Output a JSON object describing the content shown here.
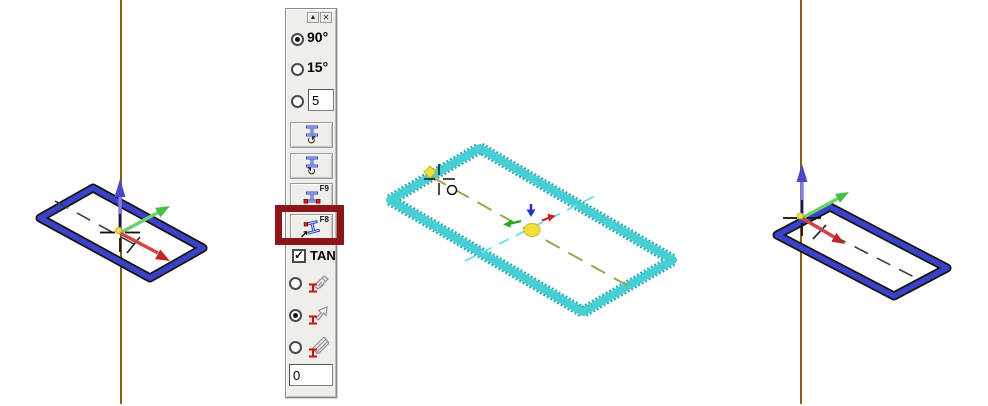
{
  "colors": {
    "construction": "#8b5c10",
    "blue-shape": "#3a43c8",
    "cyan-shape": "#46cfd4",
    "cyan-edge": "#2fa8ae",
    "olive": "#a3a34e",
    "lt-cyan": "#7adfe2",
    "axis-z": "#8080e0",
    "axis-z-head": "#4a4ac8",
    "axis-y": "#6fd06f",
    "axis-y-head": "#46be46",
    "axis-x": "#d04545",
    "axis-x-head": "#c22525",
    "marker-yellow": "#f1df3c",
    "highlight-red": "#8b1518",
    "panel-bg": "#f0eeeb"
  },
  "panel": {
    "titlebar": {
      "collapse_icon": "▲",
      "close_icon": "✕"
    },
    "angles": [
      {
        "label": "90°",
        "selected": true
      },
      {
        "label": "15°",
        "selected": false
      }
    ],
    "custom_angle": {
      "value": "5",
      "selected": false
    },
    "buttons": [
      {
        "name": "rotate-beam-ccw",
        "icon": "↺"
      },
      {
        "name": "rotate-beam-cw",
        "icon": "↻"
      },
      {
        "name": "place-beam-f9",
        "fkey": "F9"
      },
      {
        "name": "place-beam-f8",
        "fkey": "F8",
        "highlighted": true
      }
    ],
    "tan": {
      "label": "TAN",
      "checked": true,
      "check_icon": "✓"
    },
    "modes": [
      {
        "name": "beam-extrude",
        "selected": false
      },
      {
        "name": "beam-flip",
        "selected": true
      },
      {
        "name": "beam-hatch",
        "selected": false
      }
    ],
    "offset": {
      "value": "0"
    }
  }
}
